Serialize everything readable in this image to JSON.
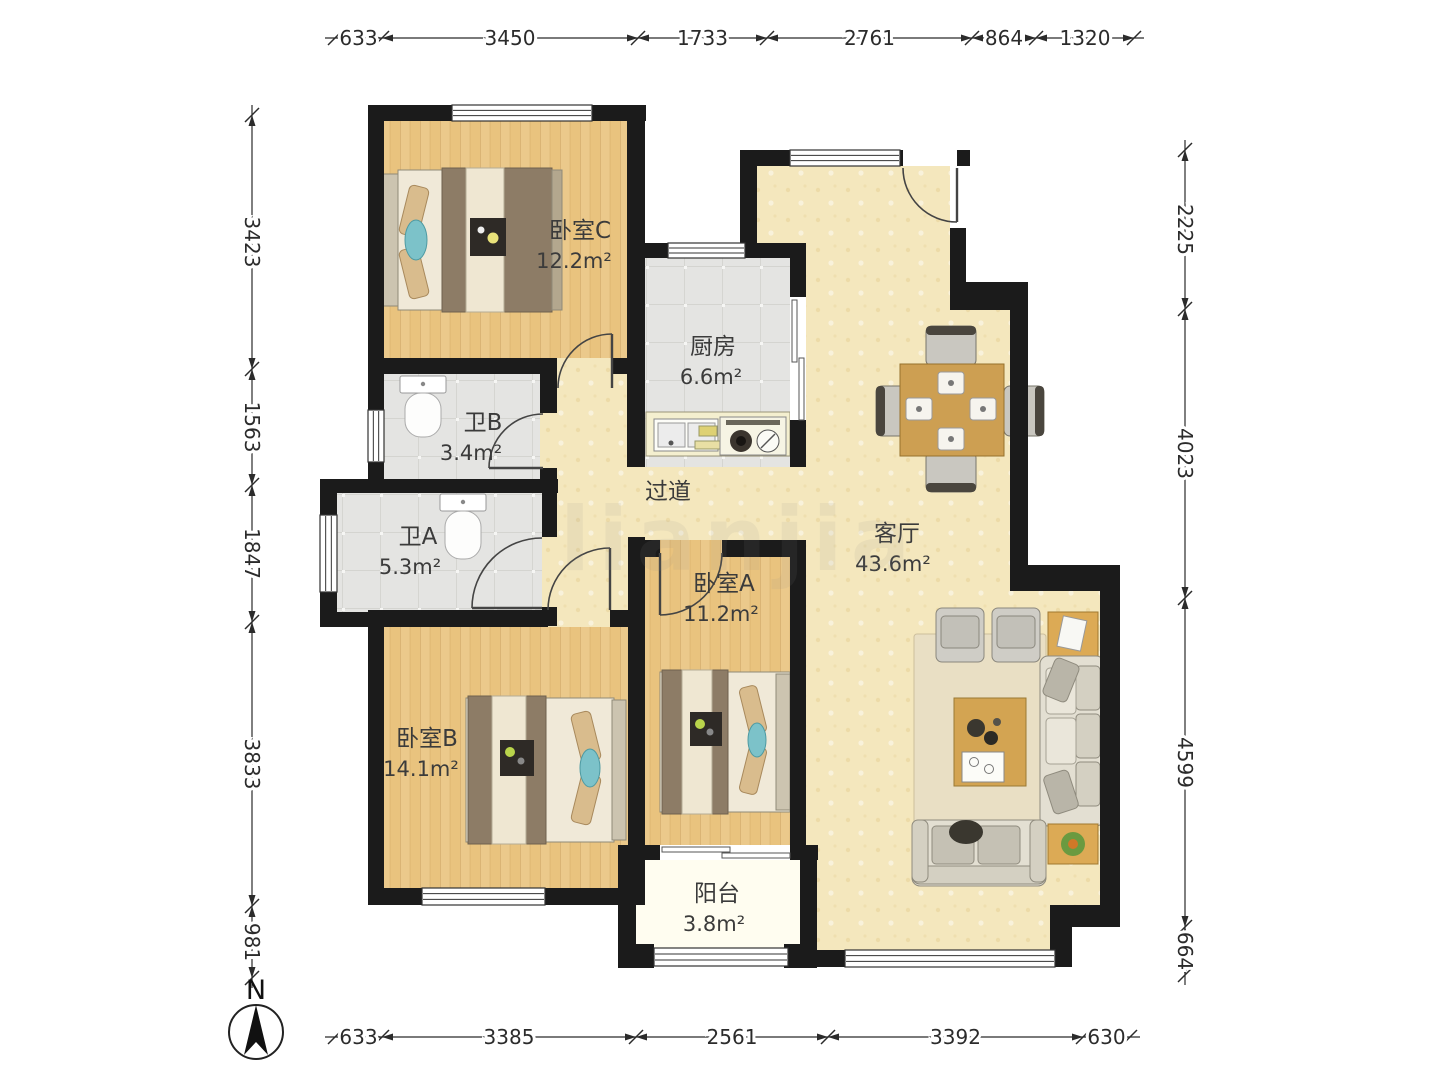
{
  "compass": {
    "label": "N"
  },
  "watermark": "lianjia",
  "rooms": [
    {
      "name": "卧室C",
      "area": "12.2m²"
    },
    {
      "name": "厨房",
      "area": "6.6m²"
    },
    {
      "name": "卫B",
      "area": "3.4m²"
    },
    {
      "name": "卫A",
      "area": "5.3m²"
    },
    {
      "name": "过道",
      "area": ""
    },
    {
      "name": "客厅",
      "area": "43.6m²"
    },
    {
      "name": "卧室A",
      "area": "11.2m²"
    },
    {
      "name": "卧室B",
      "area": "14.1m²"
    },
    {
      "name": "阳台",
      "area": "3.8m²"
    }
  ],
  "dimensions": {
    "top": [
      "633",
      "3450",
      "1733",
      "2761",
      "864",
      "1320"
    ],
    "bottom": [
      "633",
      "3385",
      "2561",
      "3392",
      "630"
    ],
    "left": [
      "3423",
      "1563",
      "1847",
      "3833",
      "981"
    ],
    "right": [
      "2225",
      "4023",
      "4599",
      "664"
    ]
  },
  "colors": {
    "wall": "#1b1b1b",
    "wood_floor": "#e9c37e",
    "living_floor": "#f4e7bd",
    "tile_floor": "#e4e4e2",
    "balcony_floor": "#fffdf0",
    "accent_table": "#cd9f52"
  }
}
